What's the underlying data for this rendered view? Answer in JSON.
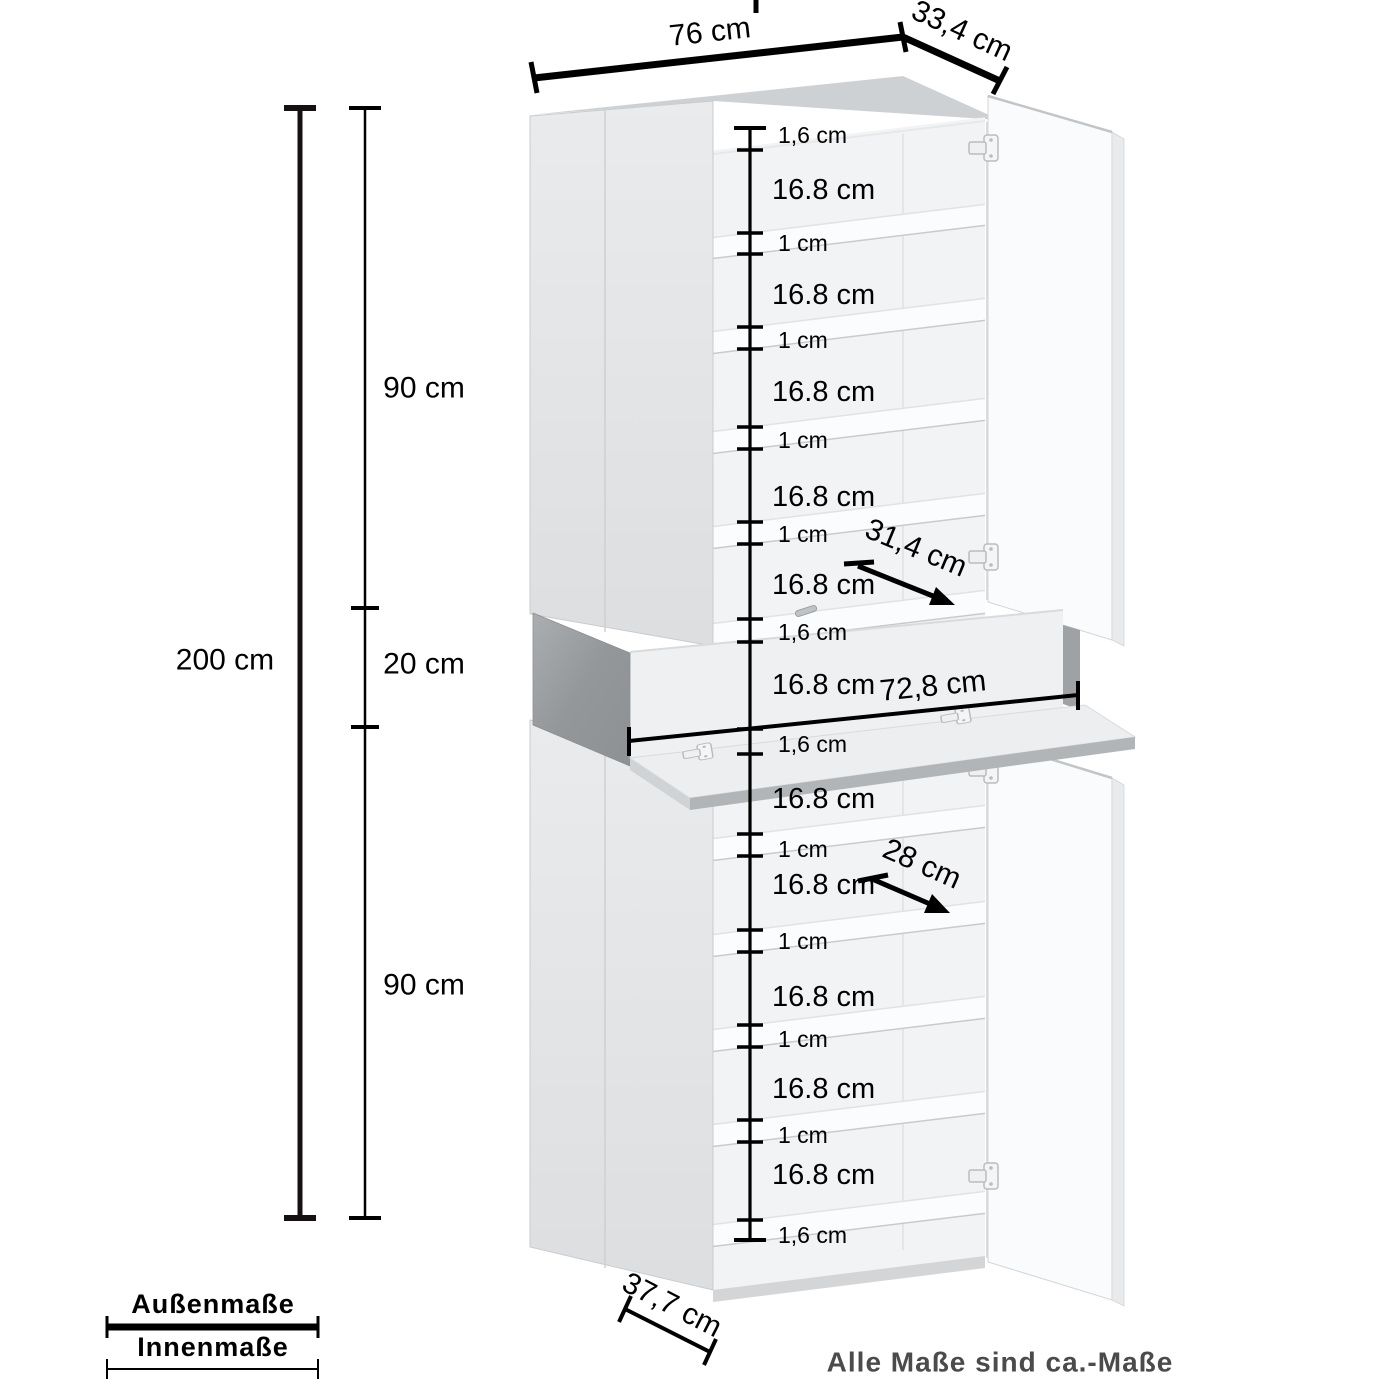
{
  "product_diagram": {
    "outer": {
      "width_top": "76 cm",
      "depth_top": "33,4 cm",
      "height_total": "200 cm"
    },
    "sections": [
      "90 cm",
      "20 cm",
      "90 cm"
    ],
    "inner_segments": [
      "1,6 cm",
      "16.8 cm",
      "1 cm",
      "16.8 cm",
      "1 cm",
      "16.8 cm",
      "1 cm",
      "16.8 cm",
      "1 cm",
      "16.8 cm",
      "1,6 cm",
      "16.8 cm",
      "1,6 cm",
      "16.8 cm",
      "1 cm",
      "16.8 cm",
      "1 cm",
      "16.8 cm",
      "1 cm",
      "16.8 cm",
      "1 cm",
      "16.8 cm",
      "1,6 cm"
    ],
    "diagonals": {
      "upper_shelf_depth": "31,4 cm",
      "niche_width": "72,8 cm",
      "lower_shelf_depth": "28 cm",
      "base_depth": "37,7 cm"
    }
  },
  "legend": {
    "outer_label": "Außenmaße",
    "inner_label": "Innenmaße"
  },
  "footnote": "Alle Maße sind ca.-Maße",
  "colors": {
    "dimension_line": "#000000",
    "footnote_text": "#4b4b4b",
    "door_gray": "#e4e6e8",
    "concrete_panel": "#9a9da0",
    "interior": "#f2f3f4"
  }
}
